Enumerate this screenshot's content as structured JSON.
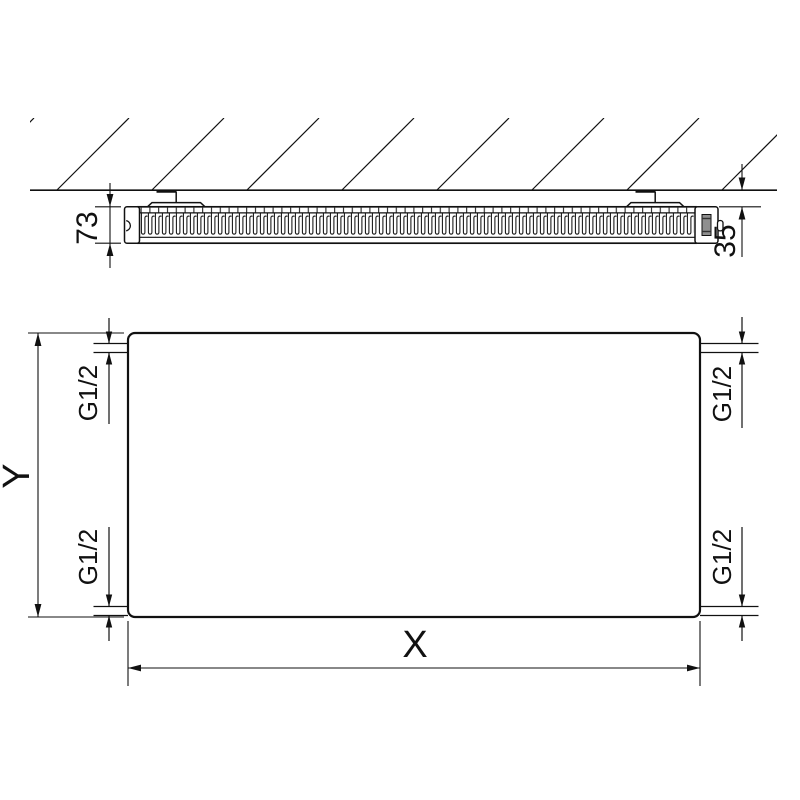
{
  "drawing": {
    "type": "technical-drawing",
    "subject": "flat-panel-radiator-dimension-diagram",
    "colors": {
      "line": "#111111",
      "background": "#ffffff",
      "plug_fill": "#8f8f8f"
    },
    "side_view": {
      "depth_label": "73",
      "wall_distance_label": "35"
    },
    "front_view": {
      "width_label": "X",
      "height_label": "Y",
      "connections": [
        {
          "position": "top-left",
          "thread": "G1/2"
        },
        {
          "position": "top-right",
          "thread": "G1/2"
        },
        {
          "position": "bottom-left",
          "thread": "G1/2"
        },
        {
          "position": "bottom-right",
          "thread": "G1/2"
        }
      ]
    }
  }
}
